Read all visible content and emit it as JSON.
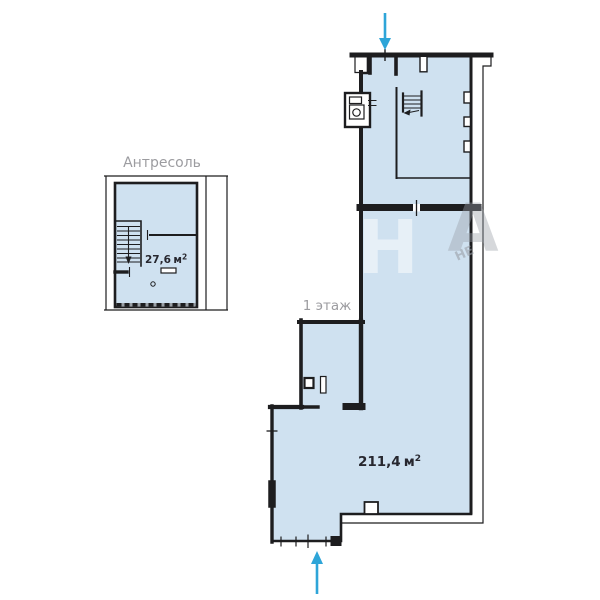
{
  "plans": {
    "mezzanine": {
      "title": "Антресоль",
      "area": {
        "value": "27,6",
        "unit": "м",
        "sup": "2"
      }
    },
    "first_floor": {
      "label": "1 этаж",
      "area": {
        "value": "211,4",
        "unit": "м",
        "sup": "2"
      }
    }
  },
  "watermark": {
    "letter_white": "Н",
    "letter_gray": "А",
    "fragment": "НЕ"
  },
  "colors": {
    "background": "#ffffff",
    "floor_fill": "#cfe1f0",
    "wall": "#1d1d1f",
    "arrow": "#2ea5d8",
    "label_gray": "#9c9ca0",
    "area_text": "#27272f",
    "watermark_gray": "#9aa0a8"
  }
}
